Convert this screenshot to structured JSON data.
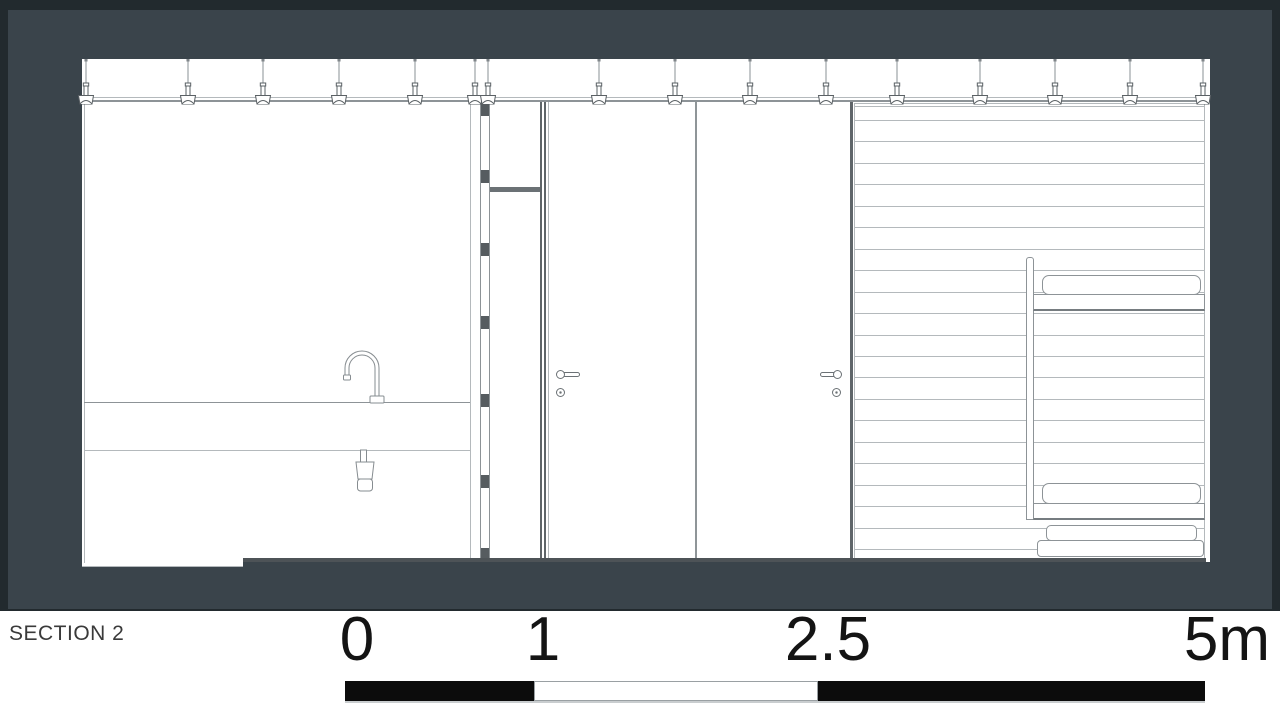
{
  "footer": {
    "title": "SECTION 2",
    "scale": {
      "labels": [
        "0",
        "1",
        "2.5",
        "5m"
      ],
      "unit": "m",
      "segments": [
        {
          "from": 0,
          "to": 1,
          "filled": true
        },
        {
          "from": 1,
          "to": 2.5,
          "filled": false
        },
        {
          "from": 2.5,
          "to": 5,
          "filled": true
        }
      ]
    }
  },
  "drawing": {
    "pendant_xs": [
      86,
      188,
      263,
      339,
      415,
      475,
      488,
      599,
      675,
      750,
      826,
      897,
      980,
      1055,
      1130,
      1203
    ],
    "slats": {
      "x": 855,
      "width": 349,
      "y_start": 120,
      "spacing": 21.45,
      "count": 21
    },
    "stud_blocks": [
      [
        100,
        16
      ],
      [
        170,
        13
      ],
      [
        243,
        13
      ],
      [
        316,
        13
      ],
      [
        394,
        13
      ],
      [
        475,
        13
      ],
      [
        548,
        12
      ]
    ]
  },
  "colors": {
    "background": "#3a444b",
    "frame": "#222a2e",
    "paper": "#ffffff",
    "line_light": "#b4b9bc",
    "line_mid": "#8d9397",
    "line_dark": "#5f6569",
    "poche": "#565c60",
    "scale_black": "#0c0c0c"
  }
}
